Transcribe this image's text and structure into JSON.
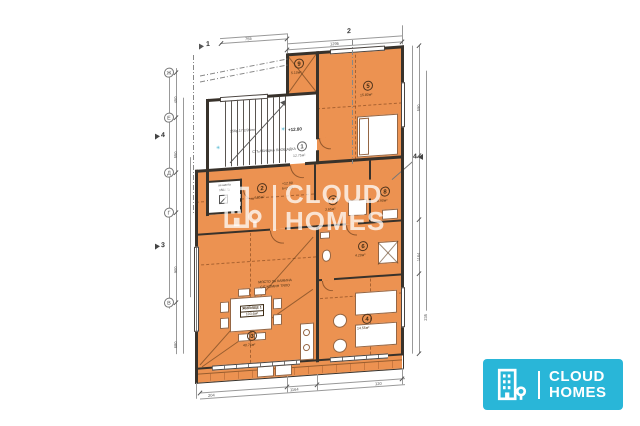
{
  "watermark": {
    "brand_line1": "CLOUD",
    "brand_line2": "HOMES"
  },
  "logo": {
    "brand_line1": "CLOUD",
    "brand_line2": "HOMES",
    "accent_color": "#29b6d8"
  },
  "plan": {
    "stair": {
      "level": "+12.80",
      "landing_label": "СТЪЛБИЩНА ПЛОЩАДКА",
      "treads_note": "15бр.17.2/28см",
      "landing_room": {
        "num": "1",
        "area": "12.75м²"
      }
    },
    "elevator": {
      "label": "ас.шахта",
      "size": "150/175"
    },
    "corridor_note1": "+12.80",
    "corridor_note2": "h=2.60",
    "living": {
      "fireplace_note1": "МЯСТО ЗА КАМИНА",
      "fireplace_note2": "С/Г КОМИН ТЯЛО",
      "unit_label": "ЖИЛИЩЕ 1",
      "unit_area": "103.6м²"
    },
    "rooms": [
      {
        "num": "2",
        "area": "4.85м²"
      },
      {
        "num": "3",
        "area": "40.75м²"
      },
      {
        "num": "4",
        "area": "14.55м²"
      },
      {
        "num": "5",
        "area": "15.80м²"
      },
      {
        "num": "6",
        "area": "4.20м²"
      },
      {
        "num": "7",
        "area": "3.65м²"
      },
      {
        "num": "8",
        "area": "8.90м²"
      },
      {
        "num": "9",
        "area": "5.10м²"
      }
    ],
    "grid": {
      "axis_top": [
        "1",
        "2"
      ],
      "left_letters": [
        "Ж",
        "Е",
        "Д",
        "Г",
        "В"
      ],
      "section_left": [
        "4",
        "3"
      ],
      "section_right": "4"
    },
    "dims": {
      "top": [
        "755",
        "1295"
      ],
      "right": [
        "590",
        "1164",
        "235"
      ],
      "left": [
        "450",
        "550",
        "900",
        "680"
      ],
      "bottom": [
        "204",
        "1164",
        "120"
      ]
    }
  }
}
